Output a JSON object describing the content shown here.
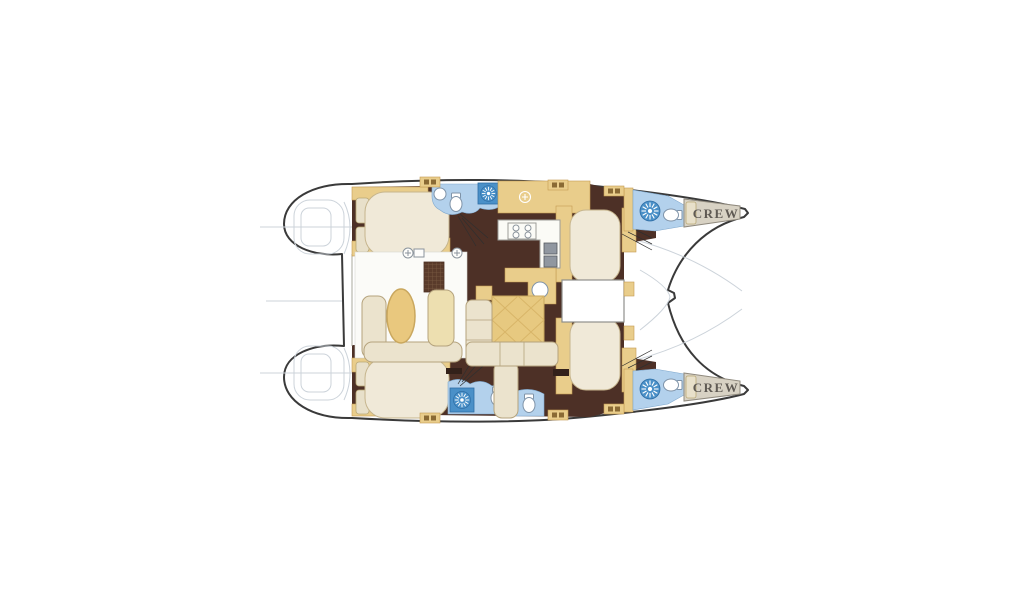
{
  "diagram": {
    "type": "boat-floor-plan",
    "subject": "catamaran interior layout, top view, bows to the right",
    "labels": {
      "crew_port": "CREW",
      "crew_starboard": "CREW"
    },
    "colors": {
      "outline_dark": "#3a3a3a",
      "floor_wood": "#4d3026",
      "cabinet_tan": "#e9cd8b",
      "cabinet_tan_stroke": "#c49a52",
      "upholstery_cream": "#ebe3cd",
      "upholstery_stroke": "#b5a37d",
      "bed_cream": "#f0e9d8",
      "bed_stroke": "#c6b58d",
      "bath_blue": "#b3d1ec",
      "bath_blue_dark": "#4a90c8",
      "crew_beige": "#d8d2c4",
      "crew_text": "#5f5a54",
      "counter_white": "#fbfbf6",
      "faint_gray": "#ccd3da"
    },
    "icons": {
      "shower": "sunburst-circle",
      "toilet": "ellipse-with-tank",
      "sink": "circle-with-cross",
      "stove": "four-burner-circles",
      "hatch": "tan-rect-with-slats",
      "stairs": "fan-lines",
      "trampoline": "faint-curves"
    }
  }
}
